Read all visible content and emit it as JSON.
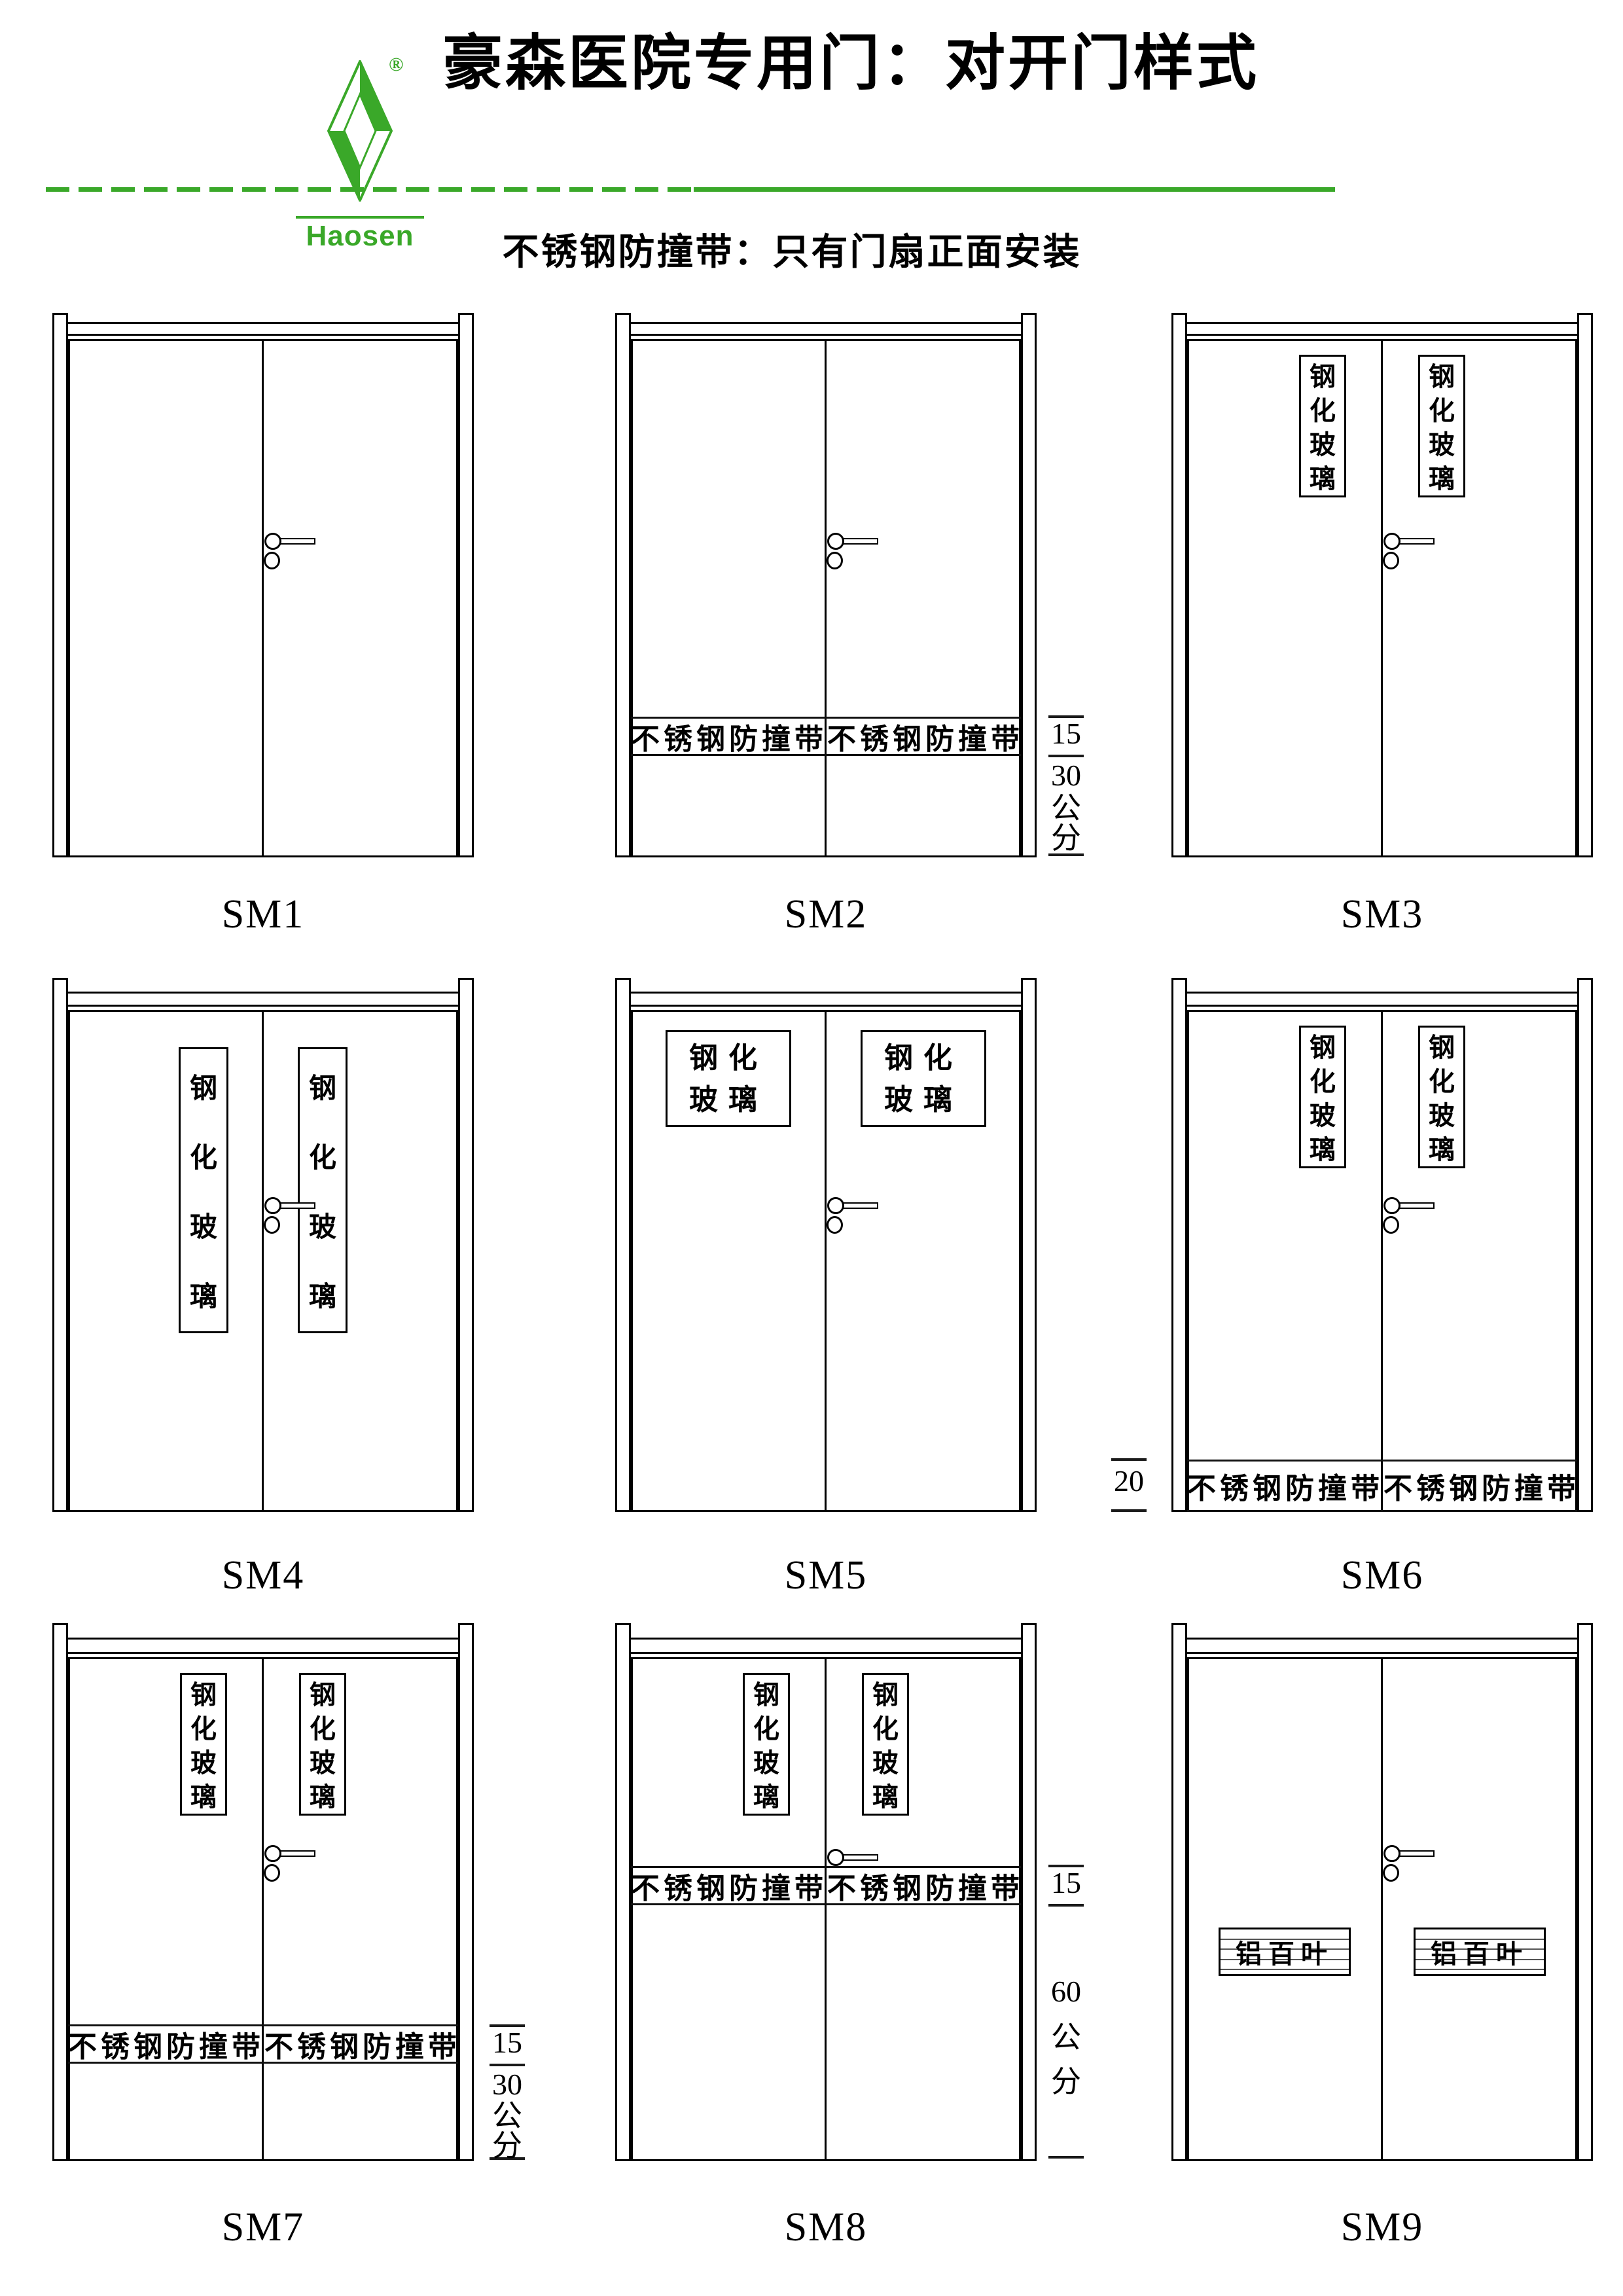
{
  "header": {
    "logo": {
      "brand": "Haosen",
      "registered": "®"
    },
    "title": "豪森医院专用门：对开门样式",
    "subtitle": "不锈钢防撞带：只有门扇正面安装",
    "accent_green": "#3aa829"
  },
  "doors": [
    {
      "id": "sm1",
      "label": "SM1",
      "glass": "none"
    },
    {
      "id": "sm2",
      "label": "SM2",
      "glass": "none",
      "strip": {
        "text": "不锈钢防撞带",
        "position": "low"
      },
      "dimension": {
        "side": "right",
        "values": [
          "15",
          "30"
        ],
        "unit": "公分"
      }
    },
    {
      "id": "sm3",
      "label": "SM3",
      "glass": "vertical-short",
      "glass_text": "钢化玻璃"
    },
    {
      "id": "sm4",
      "label": "SM4",
      "glass": "vertical-tall",
      "glass_text": "钢化玻璃"
    },
    {
      "id": "sm5",
      "label": "SM5",
      "glass": "wide",
      "glass_lines": [
        "钢化",
        "玻璃"
      ]
    },
    {
      "id": "sm6",
      "label": "SM6",
      "glass": "vertical-short",
      "glass_text": "钢化玻璃",
      "strip": {
        "text": "不锈钢防撞带",
        "position": "bottom"
      },
      "dimension": {
        "side": "left",
        "values": [
          "20"
        ],
        "unit": ""
      }
    },
    {
      "id": "sm7",
      "label": "SM7",
      "glass": "vertical-short",
      "glass_text": "钢化玻璃",
      "strip": {
        "text": "不锈钢防撞带",
        "position": "low"
      },
      "dimension": {
        "side": "right",
        "values": [
          "15",
          "30"
        ],
        "unit": "公分"
      }
    },
    {
      "id": "sm8",
      "label": "SM8",
      "glass": "vertical-short",
      "glass_text": "钢化玻璃",
      "handle": "no-keyhole",
      "strip": {
        "text": "不锈钢防撞带",
        "position": "mid"
      },
      "dimension": {
        "side": "right",
        "values": [
          "15",
          "60"
        ],
        "unit": "公分"
      }
    },
    {
      "id": "sm9",
      "label": "SM9",
      "glass": "none",
      "louver": {
        "text": "铝百叶"
      }
    }
  ]
}
